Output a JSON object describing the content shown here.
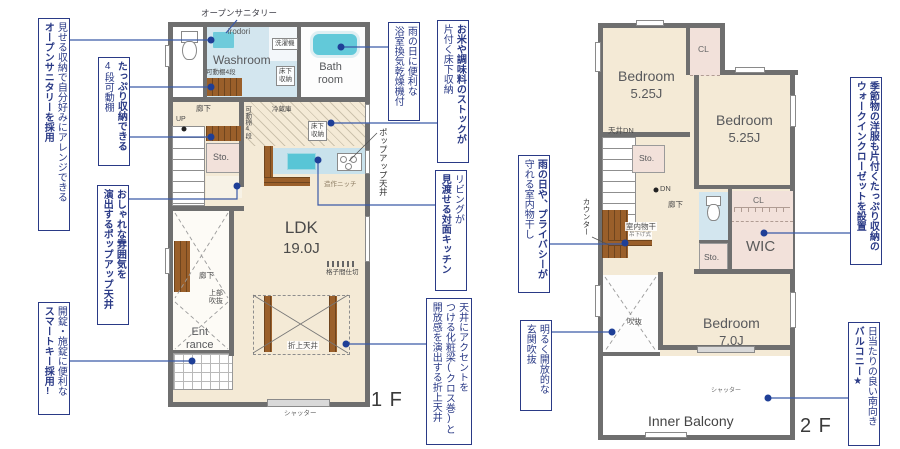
{
  "sanitary_title": {
    "main": "オープンサニタリー",
    "sub": "irodori"
  },
  "annotations": {
    "open_sanitary": {
      "l1": "見せる収納で自分好みにアレンジできる",
      "l2": "オープンサニタリーを採用"
    },
    "shelf_storage": {
      "l1": "たっぷり収納できる",
      "l2": "4段可動棚"
    },
    "popup_ceiling": {
      "l1": "おしゃれな雰囲気を",
      "l2": "演出するポップアップ天井"
    },
    "smart_key": {
      "l1": "開錠・施錠に便利な",
      "l2": "スマートキー採用!"
    },
    "bath_dryer": {
      "l1": "雨の日に便利な",
      "l2": "浴室換気乾燥機付"
    },
    "underfloor_stock": {
      "l1": "お米や調味料のストックが",
      "l2": "片付く床下収納"
    },
    "open_kitchen": {
      "l1": "リビングが",
      "l2": "見渡せる対面キッチン"
    },
    "indoor_drying": {
      "l1": "雨の日や、プライバシーが",
      "l2": "守れる室内物干し"
    },
    "accent_beam": {
      "l1": "天井にアクセントを",
      "l2": "つける化粧梁(クロス巻)と",
      "l3": "開放感を演出する折上天井"
    },
    "entrance_void": {
      "l1": "明るく開放的な",
      "l2": "玄関吹抜"
    },
    "wic_setup": {
      "l1": "季節物の洋服も片付くたっぷり収納の",
      "l2": "ウォークインクローゼットを設置"
    },
    "south_balcony": {
      "l1": "日当たりの良い南向き",
      "l2": "バルコニー★"
    }
  },
  "plan1f": {
    "floor_label": "1 F",
    "labels": {
      "washroom": "Washroom",
      "bath_l1": "Bath",
      "bath_l2": "room",
      "laundry": "洗濯機",
      "underfloor_l1": "床下",
      "underfloor_l2": "収納",
      "shelf4": "可動棚4段",
      "corridor": "廊下",
      "up": "UP",
      "sto": "Sto.",
      "fridge": "冷蔵庫",
      "niche": "造作ニッチ",
      "ldk": "LDK",
      "ldk_size": "19.0J",
      "lattice": "格子間仕切",
      "upper_void_l1": "上部",
      "upper_void_l2": "吹抜",
      "ent_l1": "Ent",
      "ent_l2": "rance",
      "folded_ceiling": "折上天井",
      "popup_ceiling": "ポップアップ天井",
      "shutter": "シャッター"
    }
  },
  "plan2f": {
    "floor_label": "2 F",
    "labels": {
      "bedroom": "Bedroom",
      "bedroom1_size": "5.25J",
      "bedroom2_size": "5.25J",
      "bedroom3_size": "7.0J",
      "cl": "CL",
      "wic": "WIC",
      "sto": "Sto.",
      "ceiling_dn": "天井DN",
      "dn": "DN",
      "corridor": "廊下",
      "counter": "カウンター",
      "drying": "室内物干",
      "drying_sub": "吊下げ式",
      "void": "吹抜",
      "inner_balcony": "Inner Balcony",
      "shutter": "シャッター"
    }
  },
  "colors": {
    "annotation_navy": "#2a3a86",
    "leader_blue": "#3a5aa8",
    "wall_gray": "#6f6f6f",
    "floor_cream": "#f4ead6",
    "water_blue": "#d3e6ef",
    "tub_cyan": "#62c9d9",
    "wood_brown": "#9a5f2a",
    "closet_pink": "#f2e1da"
  }
}
